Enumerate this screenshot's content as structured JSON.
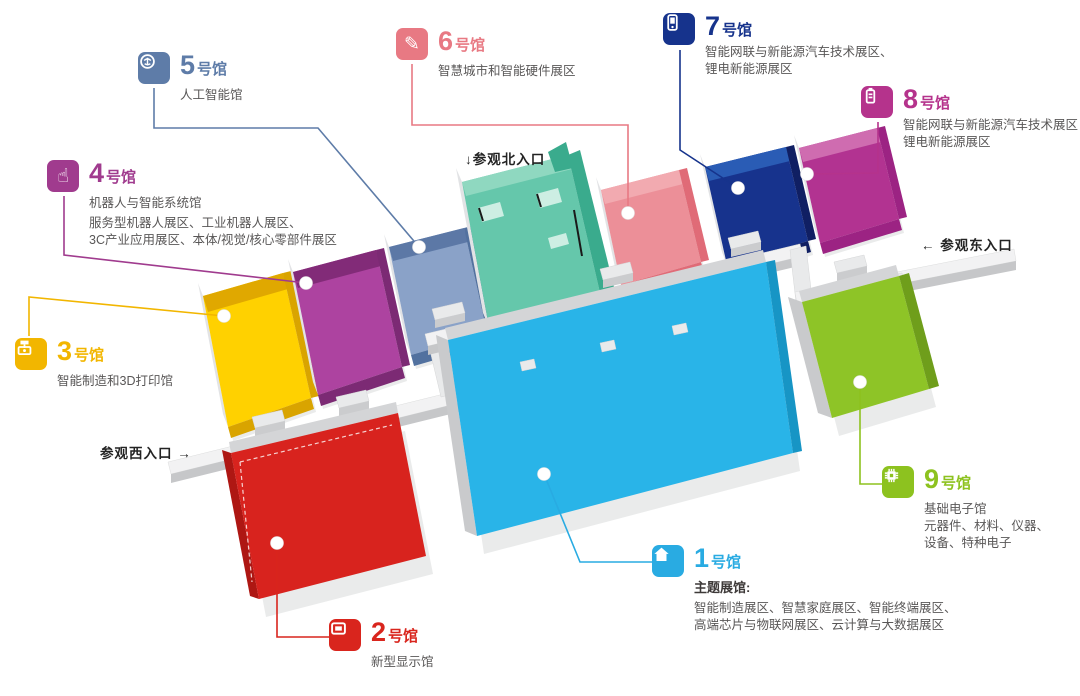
{
  "halls": [
    {
      "num": "1",
      "suffix": "号馆",
      "color": "#29abe2",
      "floor": "#29b4e8",
      "inner": "#cfd0d2",
      "dark": "#1795c5",
      "icon": "home-icon",
      "bold_line": "主题展馆:",
      "lines": [
        "智能制造展区、智慧家庭展区、智能终端展区、",
        "高端芯片与物联网展区、云计算与大数据展区"
      ]
    },
    {
      "num": "2",
      "suffix": "号馆",
      "color": "#d9251d",
      "floor": "#d8231e",
      "inner": "#d6d7d9",
      "dark": "#ae1713",
      "icon": "display-icon",
      "name": "新型显示馆",
      "lines": []
    },
    {
      "num": "3",
      "suffix": "号馆",
      "color": "#f2b600",
      "floor": "#ffd100",
      "inner": "#e0a800",
      "dark": "#d9a400",
      "icon": "3d-printer-icon",
      "name": "智能制造和3D打印馆",
      "lines": []
    },
    {
      "num": "4",
      "suffix": "号馆",
      "color": "#a03b8e",
      "floor": "#ad43a0",
      "inner": "#822b78",
      "dark": "#7c2a74",
      "icon": "hand-icon",
      "name": "机器人与智能系统馆",
      "lines": [
        "服务型机器人展区、工业机器人展区、",
        "3C产业应用展区、本体/视觉/核心零部件展区"
      ]
    },
    {
      "num": "5",
      "suffix": "号馆",
      "color": "#5e7ca8",
      "floor": "#8aa2c8",
      "inner": "#5c78a6",
      "dark": "#52719f",
      "icon": "brain-icon",
      "name": "人工智能馆",
      "lines": []
    },
    {
      "num": "6",
      "suffix": "号馆",
      "color": "#e87983",
      "floor": "#ec8f98",
      "inner": "#f2aab0",
      "dark": "#e06b77",
      "icon": "pen-icon",
      "name": "智慧城市和智能硬件展区",
      "lines": []
    },
    {
      "num": "7",
      "suffix": "号馆",
      "color": "#16338c",
      "floor": "#17338d",
      "inner": "#2a5cb5",
      "dark": "#101f63",
      "icon": "handheld-device-icon",
      "lines": [
        "智能网联与新能源汽车技术展区、",
        "锂电新能源展区"
      ]
    },
    {
      "num": "8",
      "suffix": "号馆",
      "color": "#b5338c",
      "floor": "#b23391",
      "inner": "#cf6cb0",
      "dark": "#9c2383",
      "icon": "battery-icon",
      "lines": [
        "智能网联与新能源汽车技术展区",
        "锂电新能源展区"
      ]
    },
    {
      "num": "9",
      "suffix": "号馆",
      "color": "#8dc21f",
      "floor": "#8ec427",
      "inner": "#c9cacc",
      "dark": "#6f9e1b",
      "icon": "chip-icon",
      "name": "基础电子馆",
      "lines": [
        "元器件、材料、仪器、",
        "设备、特种电子"
      ]
    }
  ],
  "north_hall": {
    "floor": "#65c7ab",
    "inner": "#8fd8c0",
    "dark": "#3aab8d",
    "block": "#cdeee3"
  },
  "entrances": {
    "north": "↓参观北入口",
    "east": "← 参观东入口",
    "west": "参观西入口 →"
  }
}
